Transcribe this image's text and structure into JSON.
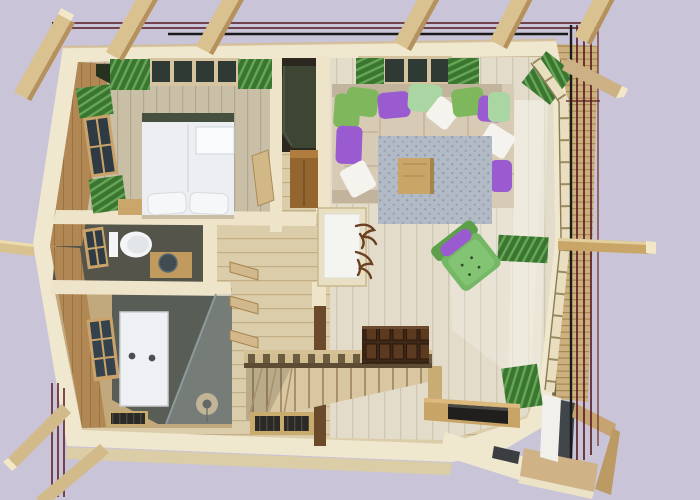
{
  "scene": {
    "description": "Top-down 3D architectural render of a timber cabin upper floor plan",
    "view": "top-down-3d-render",
    "background_color": "#c9c4d8"
  },
  "palette": {
    "bg": "#c9c4d8",
    "wall_cream": "#f0e7cf",
    "wall_cream_shade": "#e2d6b6",
    "inner_wood": "#b18754",
    "inner_wood_dark": "#9a7445",
    "floor_living": "#e3ddcb",
    "floor_living_line": "#cfc7af",
    "floor_bed": "#c9bfa7",
    "floor_bed_line": "#b2a78d",
    "floor_hall": "#dbcda9",
    "floor_hall_line": "#c3ae86",
    "floor_wc": "#55544a",
    "tile_bath": "#585d55",
    "wood_mid": "#c9a567",
    "wood_light": "#d9c190",
    "beam_side": "#b5915c",
    "beam_cap": "#f2e7c6",
    "eave_band": "#cdb07f",
    "eave_line": "#a5894f",
    "curtain_dark": "#3a762f",
    "curtain_light": "#67a558",
    "pillow_green": "#7fb85c",
    "pillow_mint": "#a9d6a3",
    "pillow_purple": "#9a5ad0",
    "pillow_white": "#f4f3ee",
    "sofa_beige": "#d7cbb6",
    "sofa_shade": "#c2b39c",
    "rug_base": "#b2bac6",
    "rug_dot": "#8d99a9",
    "wardrobe_olive": "#3c4632",
    "chest_brown": "#3e2817",
    "chest_panel": "#5b3a20",
    "door_white": "#f4f4f0",
    "glass_tint": "#aebabc",
    "tv_black": "#201f1d",
    "guide_maroon": "#56161d",
    "guide_black": "#1a1a1a",
    "slab_tan": "#dbcda6",
    "plywood": "#c5a471",
    "plywood_dark": "#bb9a63",
    "dark_steel": "#41464a",
    "toilet_white": "#f3f5f6",
    "basin_dark": "#3f4c52",
    "post_brown": "#6b4a2c",
    "fan_tan": "#cdb183",
    "pane_dark": "#2f3a34",
    "window_frame": "#d6c4a0",
    "antler_brown": "#6a3f22",
    "shadow_nook": "#2c2820",
    "wedge_dark": "#26321f"
  },
  "rooms": [
    {
      "id": "bedroom",
      "label": "Bedroom",
      "items": [
        "double-bed",
        "white-pillows",
        "headboard",
        "side-bench",
        "left-window-green-curtains",
        "top-window-band-green-curtains"
      ]
    },
    {
      "id": "wc",
      "label": "WC",
      "items": [
        "toilet",
        "washbasin-counter",
        "small-window"
      ]
    },
    {
      "id": "bathroom",
      "label": "Shower bathroom",
      "items": [
        "shower-glass-panel",
        "dark-tiled-wet-zone",
        "extractor-fan",
        "slatted-bath-mat",
        "window",
        "glass-partition"
      ]
    },
    {
      "id": "hallway",
      "label": "Hallway / stair landing",
      "items": [
        "white-entry-door",
        "antler-coat-rack",
        "staircase",
        "baluster-railing",
        "floor-heating-vent",
        "diagonal-wall-shelves",
        "leaning-board",
        "dark-newel-post"
      ]
    },
    {
      "id": "living-room",
      "label": "Living room",
      "items": [
        "l-shaped-sofa",
        "throw-pillows-green-purple-white",
        "gray-patterned-rug",
        "square-coffee-table",
        "green-tufted-armchair-with-purple-bolster",
        "dark-chest-of-drawers",
        "tv-console",
        "flat-tv",
        "olive-wardrobe",
        "wood-cabinet",
        "panoramic-window-wall",
        "green-curtains"
      ]
    },
    {
      "id": "porch",
      "label": "Entry porch / chimney bay",
      "items": [
        "white-wall",
        "plywood-walls",
        "dark-flue-strip"
      ]
    }
  ],
  "structure": {
    "top_rafter_tails": 6,
    "bottom_left_rafter_tails": 2,
    "right_side_beams": 1,
    "left_side_beams": 1,
    "corner_hip_beams": 1,
    "guide_lines_top": 3,
    "guide_lines_right": 5,
    "guide_lines_bottom_left": 3
  }
}
